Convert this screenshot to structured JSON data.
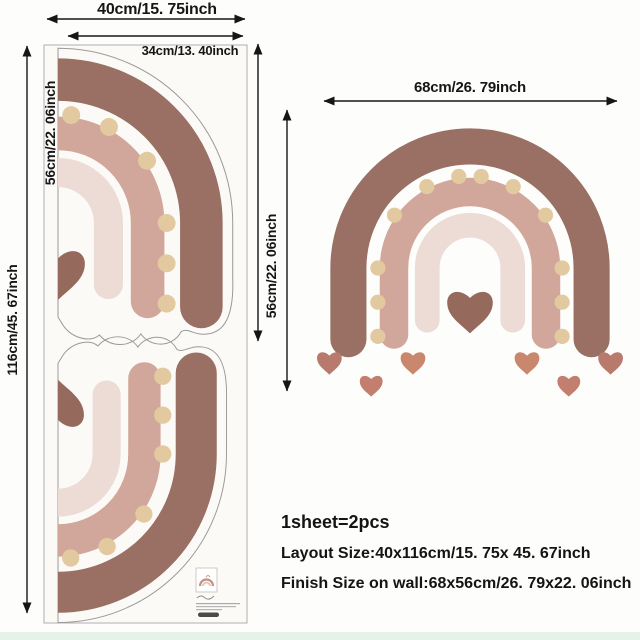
{
  "dimensions": {
    "sheet_width": "40cm/15. 75inch",
    "piece_width": "34cm/13. 40inch",
    "sheet_height": "116cm/45. 67inch",
    "piece_height": "56cm/22. 06inch",
    "wall_height": "56cm/22. 06inch",
    "wall_width": "68cm/26. 79inch"
  },
  "product_info": {
    "pieces_line": "1sheet=2pcs",
    "layout_line": "Layout Size:40x116cm/15. 75x 45. 67inch",
    "finish_line": "Finish Size on wall:68x56cm/26. 79x22. 06inch"
  },
  "colors": {
    "arc_outer": "#997063",
    "arc_middle": "#d2a79b",
    "arc_inner": "#ecdcd5",
    "dots": "#e2c9a0",
    "heart_center": "#95695c",
    "heart_small_1": "#c9886e",
    "heart_small_2": "#c37f6d",
    "heart_small_3": "#b87a6c",
    "sheet_fill": "#fcfaf7",
    "sheet_border": "#b0b0b0",
    "arrow": "#161616",
    "bottom_strip": "#e4f2e8"
  }
}
